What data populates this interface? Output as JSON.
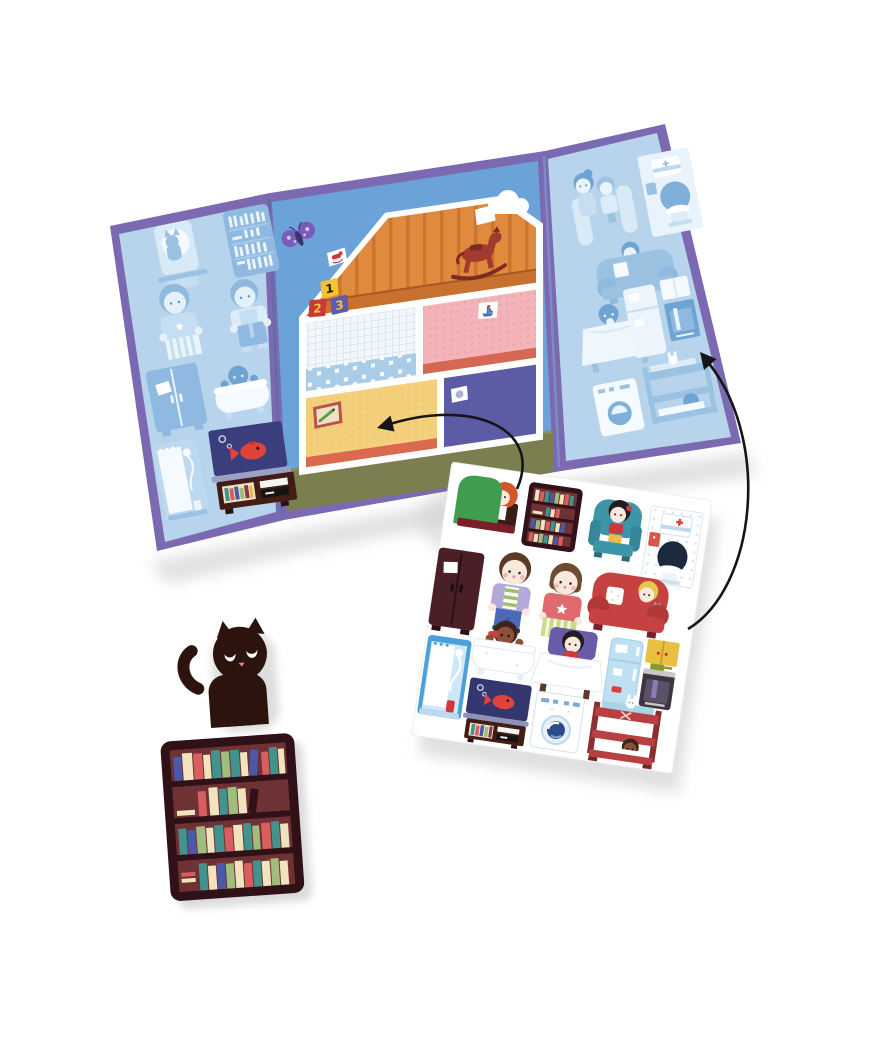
{
  "palette": {
    "board_border": "#7b6ab2",
    "flap_bg": "#b7d4ec",
    "center_sky": "#6ba3d8",
    "ghost_light": "#d9eaf7",
    "ghost_mid": "#9cc2e2",
    "ghost_dark": "#6fa3d1",
    "attic_floor": "#e08a3e",
    "pink_room": "#f2b4b8",
    "blue_room_band": "#a9cce8",
    "yellow_room": "#f5d07c",
    "purple_room": "#5c5ca6",
    "ground": "#7b7e4f",
    "arrow": "#151515",
    "sheet_bg": "#ffffff",
    "cat_black": "#2d130e",
    "bookshelf_brown": "#2f1117",
    "red_accent": "#c64242",
    "teal_accent": "#3d96a8",
    "green_accent": "#3f9d4f"
  },
  "board": {
    "center_panel": {
      "blocks": [
        {
          "label": "1",
          "block_color": "#f2c431",
          "label_color": "#201a10"
        },
        {
          "label": "2",
          "block_color": "#c8393b",
          "label_color": "#f2c431"
        },
        {
          "label": "3",
          "block_color": "#5b5cb0",
          "label_color": "#f2c431"
        }
      ],
      "rooms": [
        "attic",
        "blue-bedroom",
        "pink-bedroom",
        "yellow-living-room",
        "purple-bedroom"
      ],
      "decor": [
        "butterfly",
        "cloud",
        "rocking-horse",
        "crocodile-picture-frame",
        "rocking-dog-mini-sticker",
        "blank-mini-sticker",
        "sailboat-mini-sticker",
        "yarn-mini-sticker"
      ]
    },
    "left_flap": {
      "ghost_outlines": [
        "cat-window",
        "bookshelf",
        "girl",
        "boy",
        "wardrobe",
        "bathtub-kid",
        "shower"
      ],
      "placed_sticker": "fish-tank-cabinet"
    },
    "right_flap": {
      "ghost_outlines": [
        "boy-and-girl",
        "toilet-corner",
        "armchair-kid",
        "bed-kid",
        "fridge-and-stove",
        "washing-machine",
        "bunk-bed"
      ]
    }
  },
  "sticker_sheet": {
    "stickers": [
      "reading-armchair-green",
      "bookshelf-small",
      "armchair-girl-teal",
      "toilet-corner",
      "wardrobe",
      "boy",
      "girl",
      "red-sofa-kid",
      "bathtub-kid",
      "bed-kid",
      "fridge-and-stove",
      "shower",
      "fish-tank-cabinet",
      "washing-machine",
      "bunk-bed"
    ]
  },
  "loose_stickers": [
    "black-cat",
    "bookshelf-large"
  ],
  "arrows": [
    {
      "from": "sticker-sheet",
      "to": "yellow-living-room"
    },
    {
      "from": "sticker-sheet",
      "to": "right-flap-kitchen"
    }
  ]
}
